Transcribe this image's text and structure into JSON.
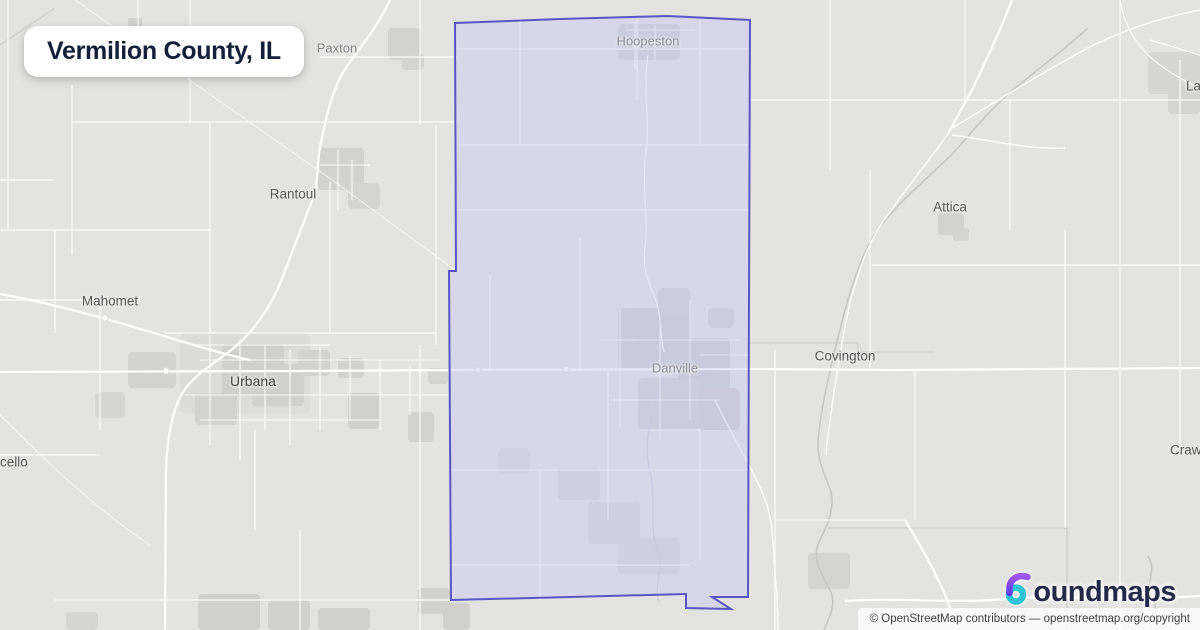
{
  "title_card": {
    "title": "Vermilion County, IL"
  },
  "county": {
    "name": "Vermilion County",
    "fill_color": "#c2c6f2",
    "stroke_color": "#5a55c5"
  },
  "map": {
    "background_color": "#e3e3e1",
    "road_color": "#ffffff",
    "river_color": "#c6c6c4"
  },
  "cities": [
    {
      "id": "paxton",
      "label": "Paxton"
    },
    {
      "id": "hoopeston",
      "label": "Hoopeston"
    },
    {
      "id": "rantoul",
      "label": "Rantoul"
    },
    {
      "id": "mahomet",
      "label": "Mahomet"
    },
    {
      "id": "urbana",
      "label": "Urbana"
    },
    {
      "id": "danville",
      "label": "Danville"
    },
    {
      "id": "covington",
      "label": "Covington"
    },
    {
      "id": "attica",
      "label": "Attica"
    },
    {
      "id": "monticello-partial",
      "label": "cello"
    },
    {
      "id": "crawfordsville-partial",
      "label": "Crawf"
    },
    {
      "id": "lafayette-partial",
      "label": "La"
    }
  ],
  "branding": {
    "logo_text": "oundmaps",
    "logo_icon": "boundmaps-b-mark",
    "navy": "#252a4a",
    "purple": "#7a4bf0",
    "teal": "#2cc3d2"
  },
  "attribution": {
    "text": "© OpenStreetMap contributors — openstreetmap.org/copyright"
  }
}
